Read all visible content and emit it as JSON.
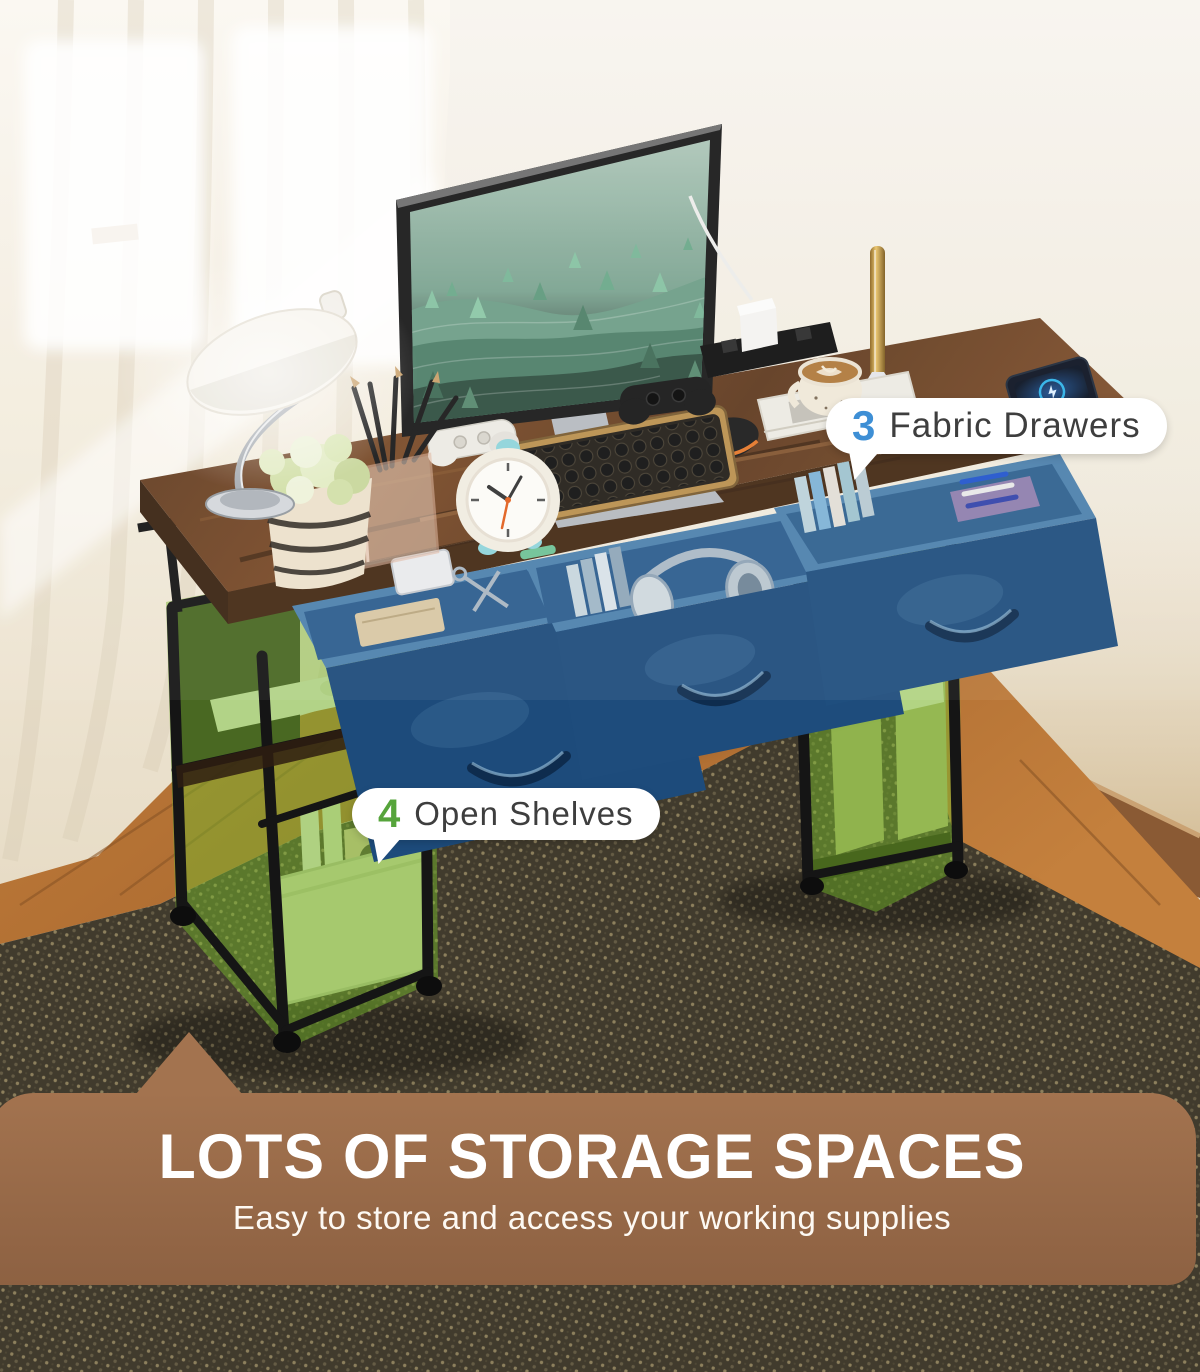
{
  "callouts": {
    "drawers": {
      "count": "3",
      "label": "Fabric Drawers",
      "count_color": "#3e8fd5"
    },
    "shelves": {
      "count": "4",
      "label": "Open Shelves",
      "count_color": "#56a43b"
    }
  },
  "banner": {
    "title": "LOTS OF STORAGE SPACES",
    "subtitle": "Easy to store and access your working supplies",
    "bg_top": "#a3734f",
    "bg_bottom": "#8d6142",
    "title_color": "#ffffff",
    "subtitle_color": "#fdf9f3"
  },
  "scene": {
    "drawer_highlight_color": "#1f4e7e",
    "shelf_highlight_color": "#76b52c",
    "desk_wood_color": "#6a4124",
    "rug_color": "#413b2d",
    "wall_color": "#f2ecdf",
    "floor_wood_color": "#b06f35",
    "objects": [
      "monitor",
      "keyboard",
      "mouse",
      "desk-lamp",
      "plant",
      "alarm-clock",
      "pencil-cup",
      "gamepad-white",
      "gamepad-black",
      "headphones",
      "coffee-cup",
      "magazine",
      "smartphone",
      "power-strip",
      "charger",
      "gold-lamp",
      "books",
      "storage-basket",
      "file-holders",
      "storage-box"
    ]
  }
}
